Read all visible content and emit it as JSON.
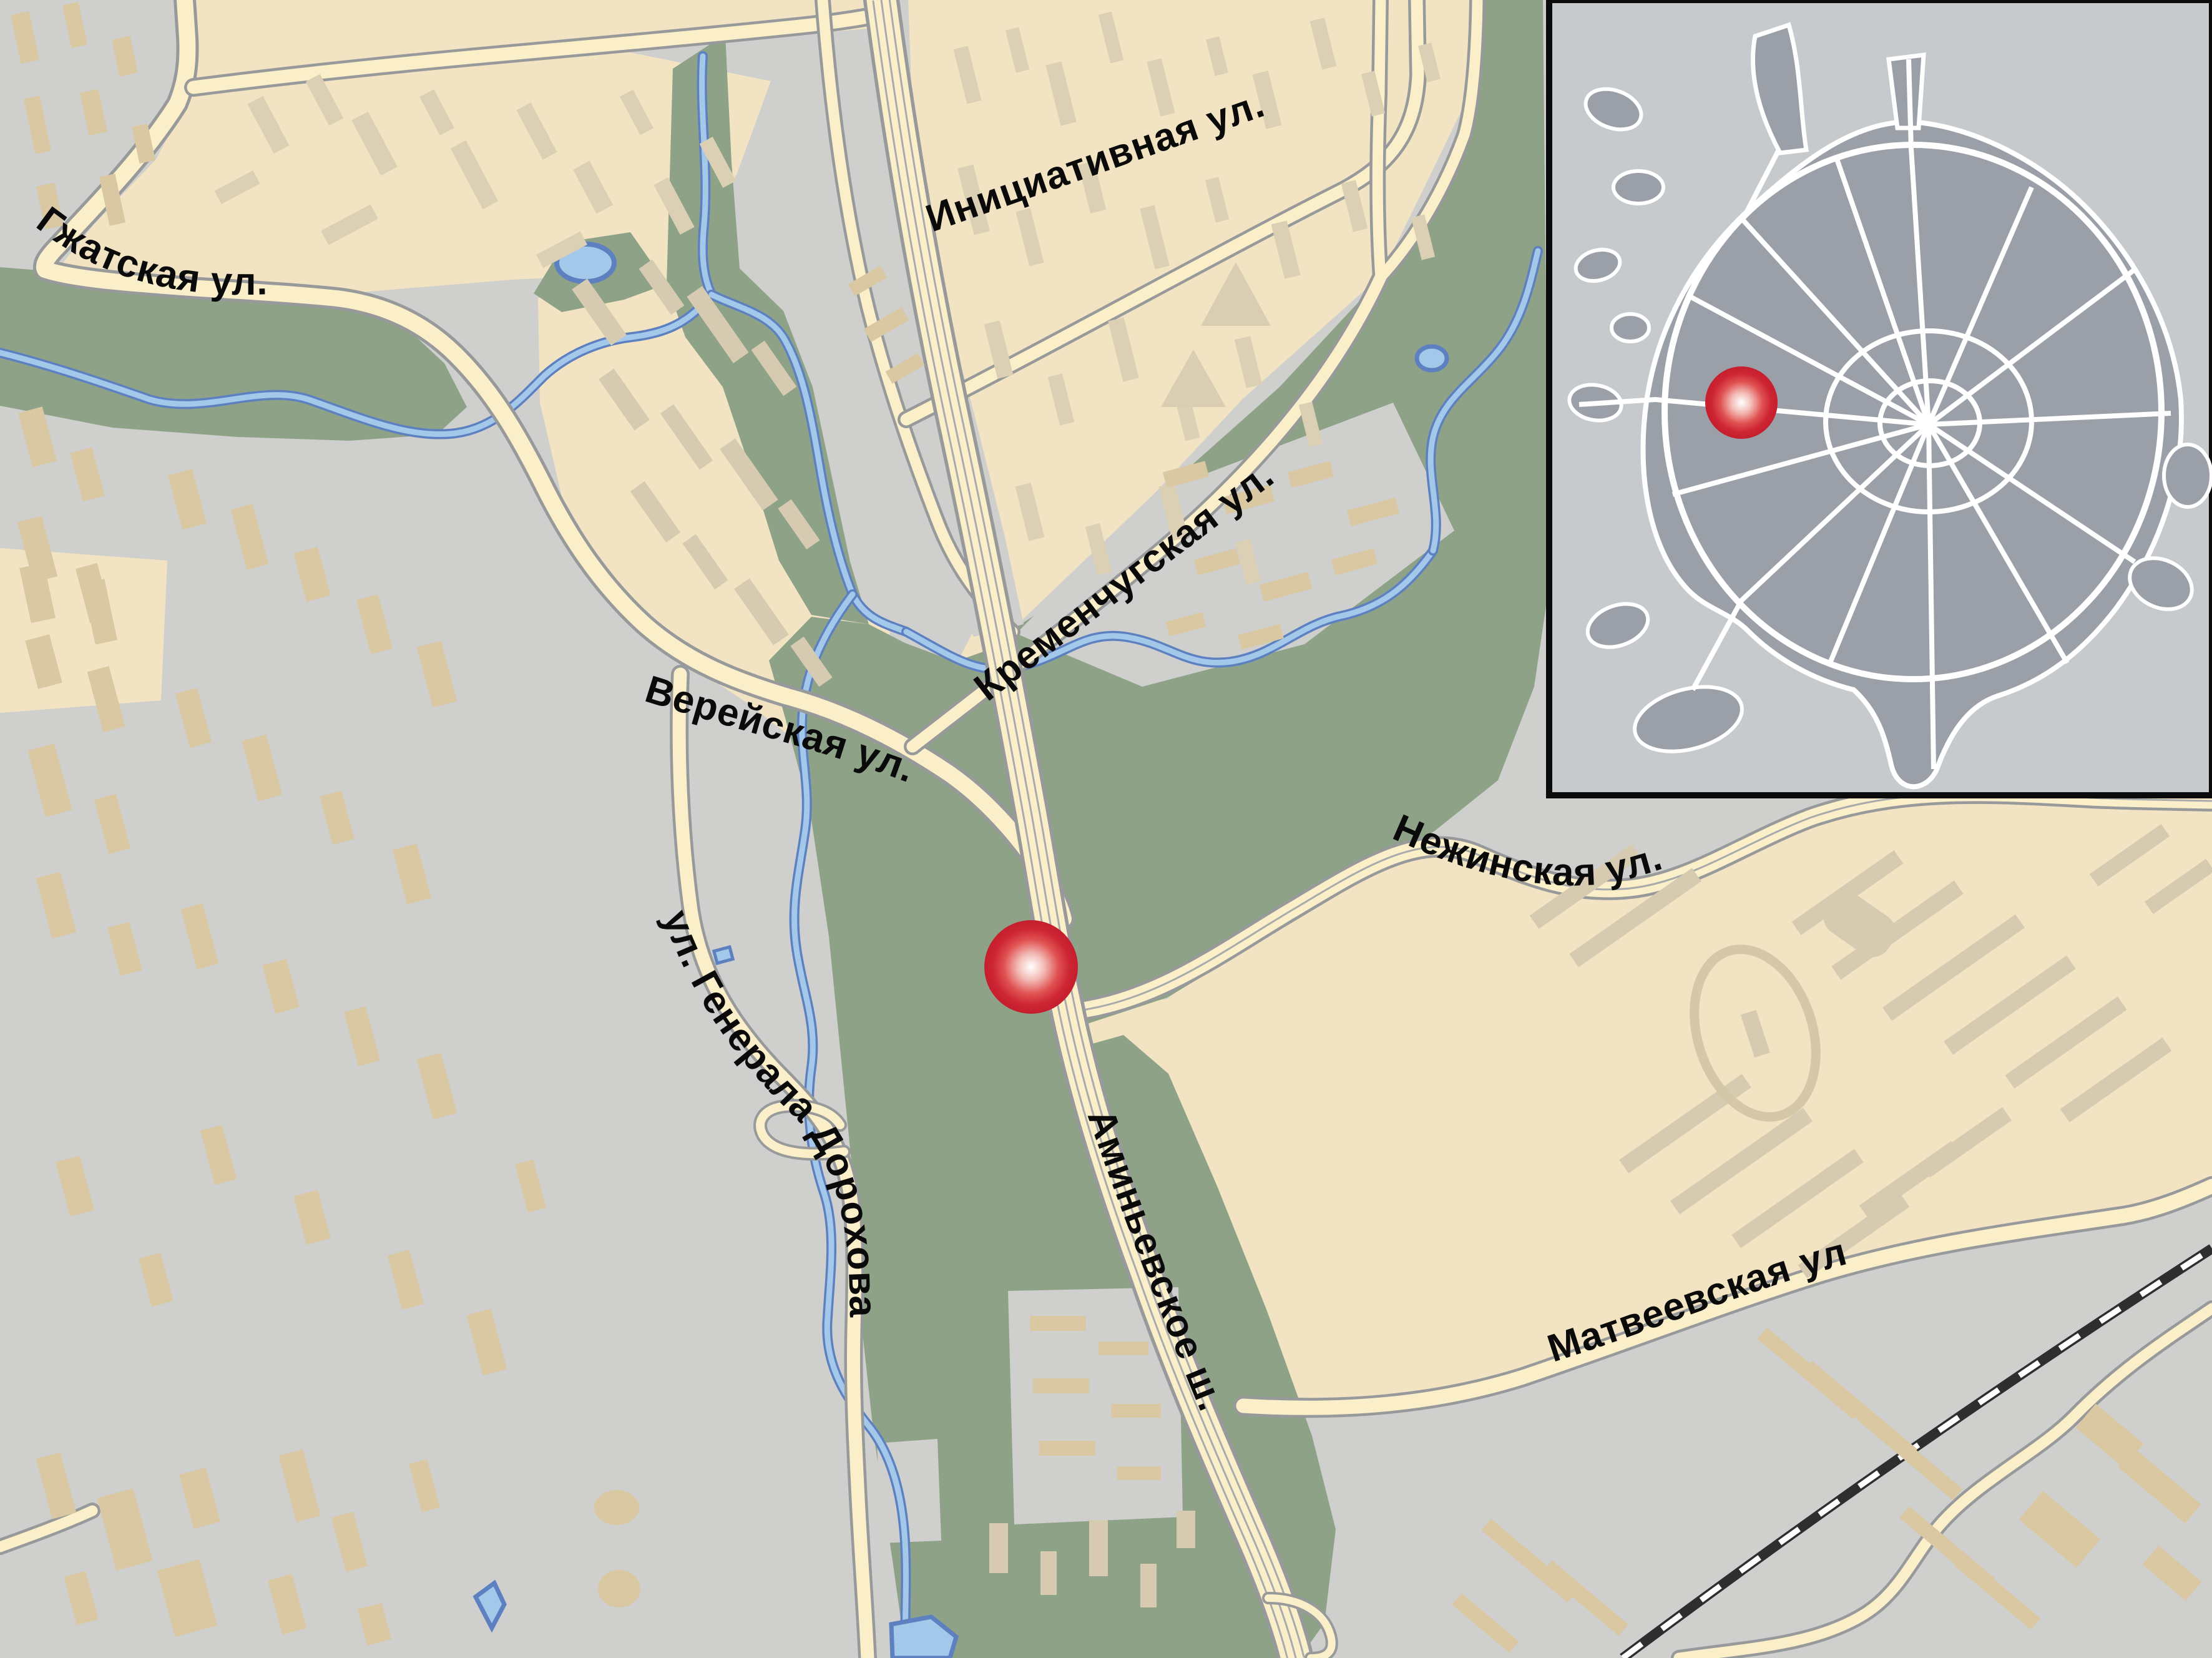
{
  "map": {
    "title": "Street map with location marker",
    "streets": {
      "gzhatskaya": "Гжатская ул.",
      "initsiativnaya": "Инициативная ул.",
      "kremenchugskaya": "Кременчугская ул.",
      "vereyskaya": "Верейская ул.",
      "nezhinskaya": "Нежинская ул.",
      "dorokhova": "ул. Генерала Дорохова",
      "aminyevskoye": "Аминьевское ш.",
      "matveyevskaya": "Матвеевская ул."
    },
    "marker": {
      "icon": "location-marker-icon",
      "color_center": "#ffffff",
      "color_edge": "#c51e2d"
    },
    "inset": {
      "description": "Moscow city overview with ring roads",
      "marker_icon": "inset-location-marker-icon"
    },
    "colors": {
      "residential": "#f2e4c2",
      "industrial": "#cfcfcd",
      "park": "#8ea288",
      "water_fill": "#a3c8e9",
      "water_edge": "#5d80c1",
      "road_fill": "#faefc8",
      "road_casing": "#97999b",
      "building_on_beige": "#dcd0b4",
      "building_on_grey": "#d9c8a2",
      "railway": "#2e2e2e",
      "inset_background": "#c7cacd",
      "inset_city": "#9ba0a8",
      "inset_roads": "#ffffff",
      "label_text": "#0a0a0a"
    }
  }
}
